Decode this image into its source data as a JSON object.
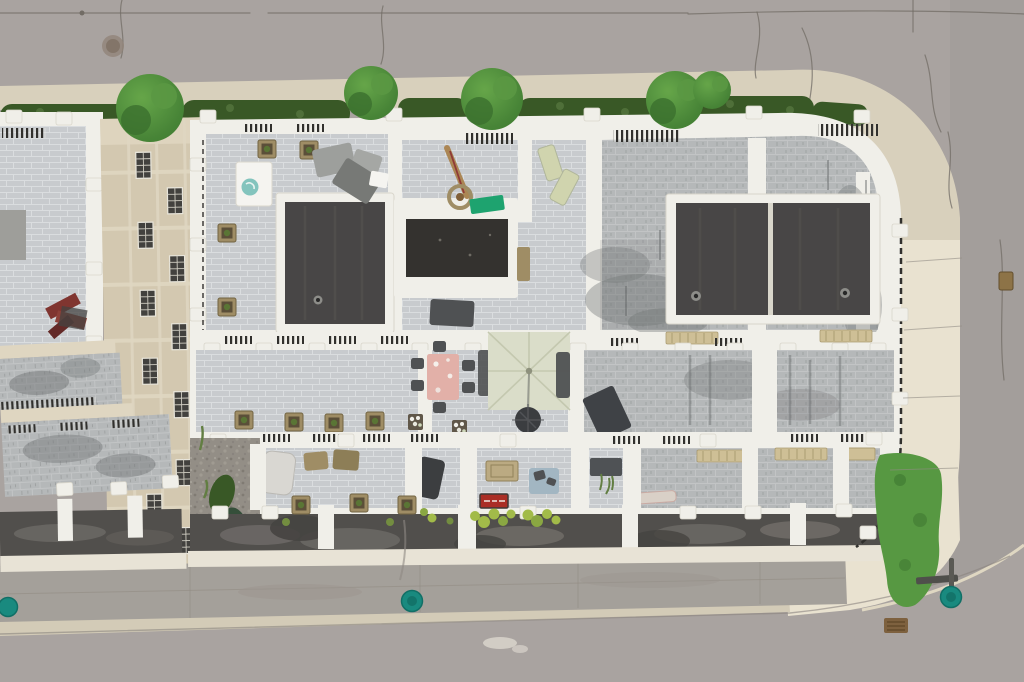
{
  "scene": {
    "type": "aerial-drone-photograph",
    "description": "Top-down aerial drone photo of a modern townhouse block with rooftop terraces and two dark flat roof volumes, bordered by an asphalt street on top wrapping around a rounded corner to the right, a rear concrete lane and street at the bottom, with street trees and hedges along the top sidewalk, rooftop patio furniture, planters, a large pale square umbrella over a seating area, a pink dining table, and teal utility covers on the pavement",
    "time_of_day": "overcast daytime"
  },
  "colors": {
    "road": "#a7a19d",
    "road-dark": "#9d9793",
    "sidewalk": "#d7cfba",
    "sidewalk-bright": "#e9e2cf",
    "curb": "#d2cab5",
    "apron": "#a29d97",
    "crack": "#6e6861",
    "seam": "#8e8981",
    "hedge": "#33531f",
    "tree": "#3e7c2e",
    "tree-light": "#61a344",
    "grass": "#52953c",
    "tile-light": "#c7cacd",
    "tile-grout": "#d9dcde",
    "tile-weather": "#b3b6b7",
    "parapet": "#f0efe9",
    "parapet-shadow": "#d8d5ca",
    "roof-dark": "#434140",
    "roof-darker": "#2e2c29",
    "beige": "#d2c7ae",
    "beige-beam": "#ded5bf",
    "window": "#3c3b38",
    "railing": "#2b2a27",
    "asphalt-strip": "#4c4a47",
    "stain": "#6f7274",
    "gravel": "#908b83",
    "teal": "#12877b",
    "teal-dark": "#0a6b62",
    "pink-table": "#e2aea6",
    "umbrella": "#d9dcc8",
    "umbrella-seam": "#c3c7ad",
    "tarp-green": "#17a06b",
    "red-sign": "#a8281f",
    "wicker": "#9c8a60",
    "planter-green": "#55712f",
    "plant-yellow": "#9fb944",
    "furniture-gray": "#9a9c99",
    "furniture-dark": "#4a4c4e",
    "white": "#f5f4f0",
    "doormat": "#b9a87e",
    "table-blue": "#9fb4c0",
    "lounger": "#cfd3ac",
    "cream-edge": "#e8e3d5"
  },
  "objects": {
    "roads": [
      {
        "label": "top-street-asphalt",
        "features": [
          "expansion cracks",
          "utility trench line",
          "manhole stain"
        ]
      },
      {
        "label": "right-street-curving-around-corner"
      },
      {
        "label": "bottom-street",
        "features": [
          "paint smudge"
        ]
      },
      {
        "label": "rear-concrete-lane",
        "features": [
          "expansion seams",
          "tire staining"
        ]
      }
    ],
    "landscaping": {
      "street_trees_count": 5,
      "hedge_rows": "continuous clipped hedge along top sidewalk",
      "grass_patch": "bright green patch at bottom-right building corner",
      "weeds": "weeds in gravel side-yard strip"
    },
    "building": {
      "type": "modern flat-roof townhouse block with white parapets",
      "dark_roof_volumes": 3,
      "stairwell_skylight": "white-framed dark opening at center",
      "roof_drains": 3,
      "left_wing": "beige-clad wing seen obliquely with gridded windows and weathered terraces",
      "terrace_floors": "light concrete pavers, weathered gray in places",
      "balcony_row": "lower balconies with planters above a dark asphalt canopy strip"
    },
    "furniture": [
      {
        "label": "square-patio-umbrella-open",
        "color": "pale sage"
      },
      {
        "label": "outdoor-dining-table",
        "color": "pink floral"
      },
      {
        "label": "dining-chairs",
        "count": 6
      },
      {
        "label": "round-bistro-table"
      },
      {
        "label": "closed-umbrella-with-basket"
      },
      {
        "label": "green-tarp"
      },
      {
        "label": "plastic-loungers",
        "count": 2
      },
      {
        "label": "gray-lounge-set"
      },
      {
        "label": "spa-table-with-teal-bowl"
      },
      {
        "label": "covered-furniture-tarp"
      },
      {
        "label": "bbq-grill"
      },
      {
        "label": "doormat"
      },
      {
        "label": "red-sign-mat"
      },
      {
        "label": "blue-side-table"
      },
      {
        "label": "wicker-planter-cubes",
        "count": 12
      },
      {
        "label": "red-folded-chairs"
      }
    ],
    "street_furniture": [
      {
        "label": "teal-utility-covers",
        "count": 3
      },
      {
        "label": "street-sign-pole"
      },
      {
        "label": "storm-drain"
      },
      {
        "label": "utility-box-brown"
      }
    ]
  }
}
